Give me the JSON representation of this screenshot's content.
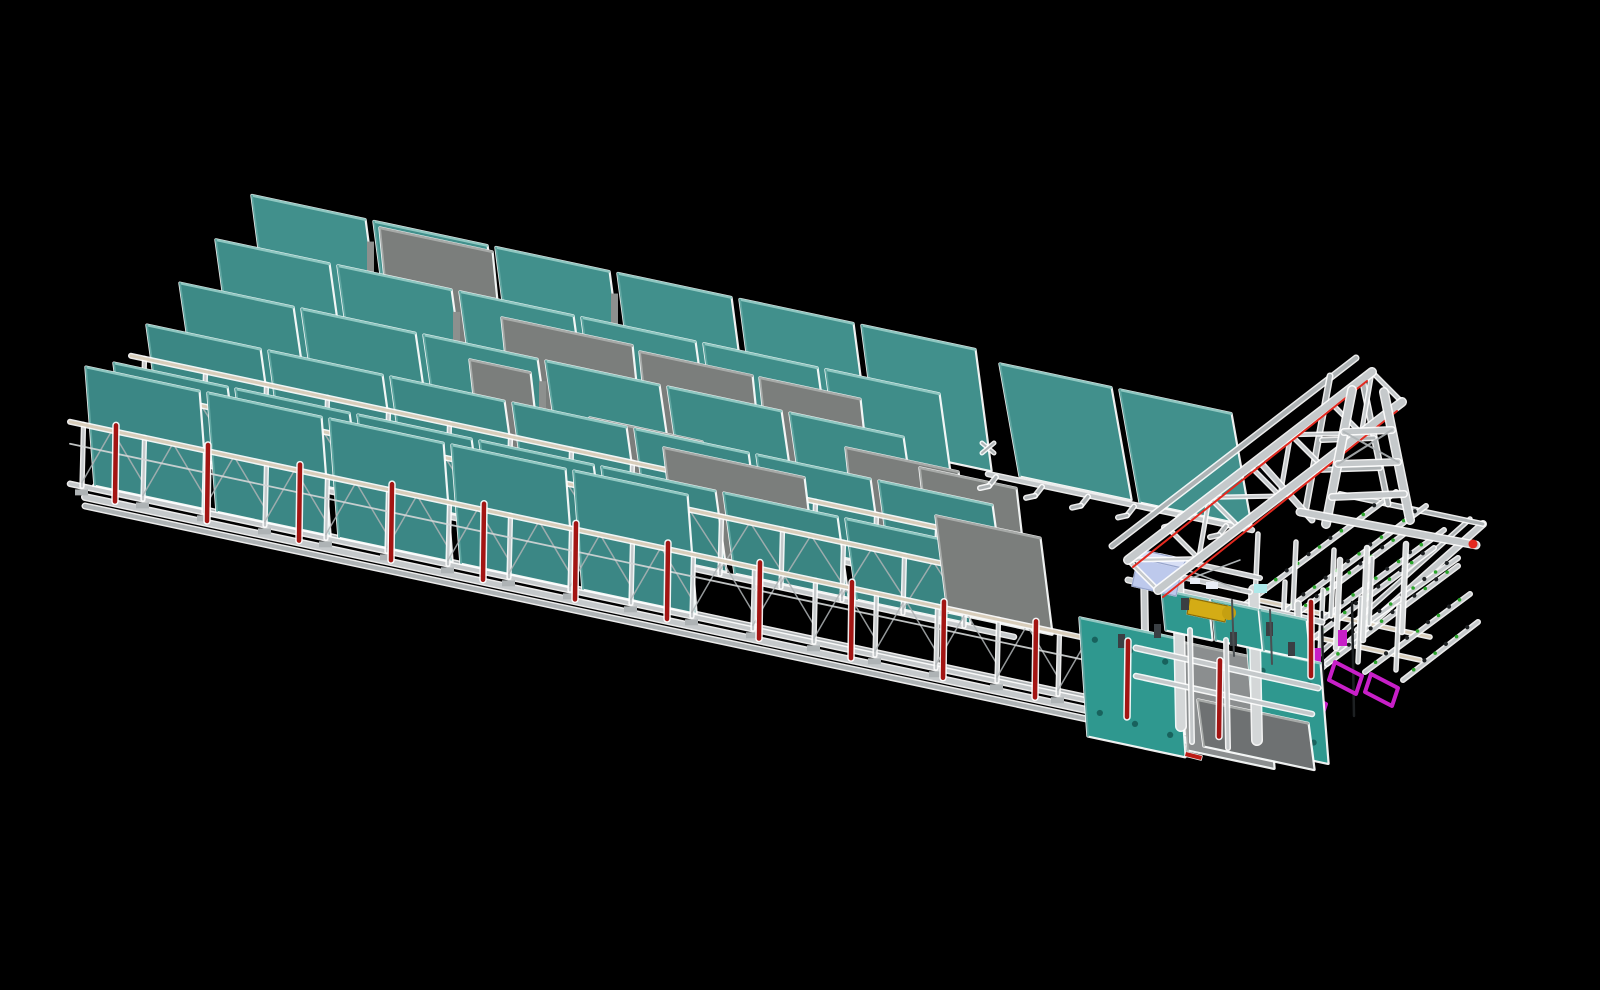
{
  "meta": {
    "background": "#000000",
    "width": 1600,
    "height": 990
  },
  "colors": {
    "bg": "#000000",
    "halo": "#FFFFFF",
    "tealEdge": "#8FC7C1",
    "tealSide": "#5FA6A1",
    "grayPanel": "#7B7E7C",
    "grayEdge": "#A7AAA8",
    "frame": "#C5C9CB",
    "frameLight": "#D4D7D8",
    "frameSoft": "#AEB3B5",
    "tan": "#D8CDBA",
    "red": "#A31513",
    "redBase": "#BB1B15",
    "redBright": "#E3291F",
    "yellow": "#D4AC15",
    "yellowDim": "#C5A011",
    "yellowDark": "#8A6D08",
    "blue": "#BDC9EC",
    "blueLight": "#D8DFF5",
    "blueEdge": "#96A4CB",
    "cyan": "#ADE9EA",
    "magenta": "#C81FC8",
    "green": "#2BA52B",
    "dark": "#3A3F43",
    "darkSoft": "#4A4F52",
    "clampDot": "#1D2022",
    "stationTeal": "#2F988F",
    "stationHole": "#18625D",
    "grayStation": "#8B8E8F",
    "grayDark": "#6E7172",
    "white2": "#E8EDF6",
    "gapSliver": "#8D908E"
  },
  "scene": {
    "rail": {
      "x0": 85,
      "y0": 497,
      "slope": 0.213
    },
    "base": {
      "front": [
        85,
        497,
        1237,
        742
      ],
      "front2dy": 9,
      "back_hint": [
        95,
        486,
        1247,
        731
      ],
      "right": [
        1237,
        742,
        1483,
        524
      ],
      "right_inner": [
        1228,
        735,
        1470,
        519
      ],
      "back_right": [
        1483,
        524,
        1340,
        494
      ]
    },
    "rows": [
      {
        "name": "panel-row-6-back",
        "x0": 252,
        "n": 6,
        "w": 113,
        "pitch": 122,
        "h": 121,
        "lean": 16,
        "off": 212,
        "fill": "#41908C",
        "gapSlivers": [
          0,
          2
        ],
        "graysBefore": []
      },
      {
        "name": "panel-row-5",
        "x0": 216,
        "n": 6,
        "w": 113,
        "pitch": 122,
        "h": 108,
        "lean": 15,
        "off": 173,
        "fill": "#3F8D89",
        "gapSlivers": [
          1,
          3
        ],
        "graysBefore": [
          {
            "tl": [
              380,
              228
            ],
            "w": 112,
            "h": 120
          }
        ]
      },
      {
        "name": "panel-row-4",
        "x0": 180,
        "n": 6,
        "w": 113,
        "pitch": 122,
        "h": 96,
        "lean": 14,
        "off": 134,
        "fill": "#3D8A86",
        "gapSlivers": [
          2
        ],
        "graysBefore": [
          {
            "tl": [
              502,
              318
            ],
            "w": 130,
            "h": 115
          },
          {
            "tl": [
              640,
              352
            ],
            "w": 112,
            "h": 115
          },
          {
            "tl": [
              760,
              378
            ],
            "w": 100,
            "h": 110
          }
        ]
      },
      {
        "name": "panel-row-3",
        "x0": 147,
        "n": 7,
        "w": 113,
        "pitch": 122,
        "h": 86,
        "lean": 12,
        "off": 95,
        "fill": "#3B8784",
        "rack": {
          "to": 1000,
          "postH": 54,
          "feet": false,
          "diag": false
        },
        "graysBefore": [
          {
            "tl": [
              470,
              360
            ],
            "w": 60,
            "h": 105
          },
          {
            "tl": [
              590,
              418
            ],
            "w": 112,
            "h": 105
          },
          {
            "tl": [
              846,
              448
            ],
            "w": 112,
            "h": 108
          },
          {
            "tl": [
              920,
              468
            ],
            "w": 96,
            "h": 104
          }
        ]
      },
      {
        "name": "panel-row-2",
        "x0": 114,
        "n": 7,
        "w": 113,
        "pitch": 122,
        "h": 80,
        "lean": 11,
        "off": 56,
        "fill": "#3A8582",
        "rack": {
          "to": 1014,
          "postH": 58,
          "feet": false,
          "diag": true
        },
        "graysBefore": [
          {
            "tl": [
              664,
              448
            ],
            "w": 140,
            "h": 100
          }
        ]
      },
      {
        "name": "panel-row-1-front",
        "x0": 86,
        "n": 5,
        "w": 113,
        "pitch": 122,
        "h": 118,
        "lean": 9,
        "off": 8,
        "fill": "#3B8785",
        "rack": {
          "to": 1164,
          "postH": 62,
          "feet": true,
          "diag": true
        },
        "graysBefore": [
          {
            "tl": [
              936,
              516
            ],
            "w": 104,
            "h": 96
          }
        ]
      }
    ],
    "right_rack": {
      "rail": [
        988,
        474,
        1252,
        530
      ],
      "feet_from": 996,
      "feet_to": 1250,
      "feet_every": 46,
      "panels": [
        {
          "tl": [
            1000,
            364
          ],
          "w": 111,
          "h": 112,
          "lean": 20
        },
        {
          "tl": [
            1120,
            390
          ],
          "w": 111,
          "h": 112,
          "lean": 20
        }
      ],
      "connector": [
        988,
        448
      ]
    },
    "grid": {
      "tanRails": [
        [
          1245,
          622,
          1420,
          660
        ],
        [
          1258,
          600,
          1430,
          637
        ]
      ],
      "beamsLow": [
        [
          1251,
          648,
          1404,
          534
        ],
        [
          1289,
          656,
          1434,
          548
        ],
        [
          1327,
          664,
          1458,
          566
        ],
        [
          1365,
          672,
          1470,
          594
        ],
        [
          1403,
          680,
          1478,
          622
        ]
      ],
      "beamsUp": [
        [
          1243,
          606,
          1396,
          492
        ],
        [
          1281,
          614,
          1426,
          506
        ],
        [
          1319,
          622,
          1444,
          530
        ],
        [
          1357,
          630,
          1458,
          558
        ]
      ],
      "pins": [
        [
          1255,
          600,
          1258,
          534
        ],
        [
          1293,
          608,
          1296,
          542
        ],
        [
          1331,
          616,
          1334,
          550
        ],
        [
          1369,
          624,
          1372,
          558
        ],
        [
          1282,
          646,
          1285,
          582
        ],
        [
          1320,
          654,
          1323,
          590
        ],
        [
          1358,
          662,
          1361,
          598
        ],
        [
          1396,
          670,
          1399,
          606
        ]
      ],
      "tallPins": [
        [
          1336,
          648,
          1340,
          560
        ],
        [
          1363,
          640,
          1367,
          548
        ],
        [
          1402,
          632,
          1406,
          544
        ]
      ],
      "darkBars": [
        [
          1322,
          612,
          1324,
          742
        ],
        [
          1352,
          602,
          1354,
          716
        ]
      ],
      "magentaRects": [
        [
          1338,
          630,
          9,
          16
        ],
        [
          1312,
          648,
          9,
          16
        ]
      ],
      "magentaUs": [
        [
          [
            1335,
            662
          ],
          [
            1362,
            676
          ],
          [
            1356,
            694
          ],
          [
            1329,
            680
          ]
        ],
        [
          [
            1371,
            674
          ],
          [
            1398,
            688
          ],
          [
            1392,
            706
          ],
          [
            1365,
            692
          ]
        ],
        [
          [
            1302,
            692
          ],
          [
            1326,
            704
          ],
          [
            1320,
            722
          ],
          [
            1296,
            710
          ]
        ]
      ]
    },
    "station": [
      {
        "t": "line",
        "p": [
          1128,
          580,
          1322,
          622
        ],
        "w": 4,
        "c": "frame",
        "g": 1
      },
      {
        "t": "line",
        "p": [
          1144,
          566,
          1146,
          700
        ],
        "w": 5,
        "c": "frame",
        "g": 1
      },
      {
        "t": "line",
        "p": [
          1298,
          604,
          1300,
          742
        ],
        "w": 5,
        "c": "frame",
        "g": 1
      },
      {
        "t": "quad",
        "tl": [
          1080,
          618
        ],
        "w": 97,
        "h": 118,
        "lean": 8,
        "f": "stationTeal",
        "holes": 6
      },
      {
        "t": "quad",
        "tl": [
          1180,
          642
        ],
        "w": 86,
        "h": 108,
        "lean": 8,
        "f": "grayStation"
      },
      {
        "t": "quad",
        "tl": [
          1248,
          648
        ],
        "w": 72,
        "h": 100,
        "lean": 8,
        "f": "stationTeal",
        "holes": 4
      },
      {
        "t": "quad",
        "tl": [
          1198,
          700
        ],
        "w": 110,
        "h": 46,
        "lean": 6,
        "f": "grayDark"
      },
      {
        "t": "line",
        "p": [
          1178,
          572,
          1181,
          726
        ],
        "w": 9,
        "c": "frameLight",
        "g": 1
      },
      {
        "t": "line",
        "p": [
          1254,
          590,
          1257,
          740
        ],
        "w": 9,
        "c": "frameLight",
        "g": 1
      },
      {
        "t": "line",
        "p": [
          1136,
          648,
          1318,
          688
        ],
        "w": 4,
        "c": "frame",
        "g": 1
      },
      {
        "t": "line",
        "p": [
          1136,
          676,
          1312,
          714
        ],
        "w": 3.5,
        "c": "frame",
        "g": 1
      },
      {
        "t": "quad",
        "tl": [
          1162,
          590
        ],
        "w": 46,
        "h": 40,
        "lean": 4,
        "f": "stationTeal"
      },
      {
        "t": "quad",
        "tl": [
          1212,
          600
        ],
        "w": 46,
        "h": 40,
        "lean": 4,
        "f": "stationTeal"
      },
      {
        "t": "quad",
        "tl": [
          1260,
          610
        ],
        "w": 46,
        "h": 40,
        "lean": 4,
        "f": "stationTeal"
      },
      {
        "t": "line",
        "p": [
          1150,
          570,
          1250,
          592
        ],
        "w": 3,
        "c": "frame",
        "g": 1
      },
      {
        "t": "line",
        "p": [
          1160,
          556,
          1260,
          578
        ],
        "w": 3,
        "c": "frame",
        "g": 1
      },
      {
        "t": "line",
        "p": [
          1160,
          560,
          1240,
          590
        ],
        "w": 1.5,
        "c": "frameSoft"
      },
      {
        "t": "line",
        "p": [
          1240,
          560,
          1160,
          590
        ],
        "w": 1.5,
        "c": "frameSoft"
      },
      {
        "t": "poly",
        "pts": [
          [
            1138,
            558
          ],
          [
            1182,
            568
          ],
          [
            1176,
            596
          ],
          [
            1132,
            586
          ]
        ],
        "f": "blue",
        "s": "blueEdge"
      },
      {
        "t": "poly",
        "pts": [
          [
            1138,
            558
          ],
          [
            1142,
            550
          ],
          [
            1186,
            560
          ],
          [
            1182,
            568
          ]
        ],
        "f": "blueLight",
        "s": "blueEdge"
      },
      {
        "t": "rect",
        "p": [
          1254,
          584,
          13,
          9
        ],
        "f": "cyan"
      },
      {
        "t": "rect",
        "p": [
          1190,
          578,
          10,
          6
        ],
        "f": "white2"
      },
      {
        "t": "rect",
        "p": [
          1206,
          582,
          12,
          7
        ],
        "f": "white2"
      },
      {
        "t": "poly",
        "pts": [
          [
            1190,
            598
          ],
          [
            1228,
            606
          ],
          [
            1225,
            622
          ],
          [
            1187,
            614
          ]
        ],
        "f": "yellow",
        "s": "yellowDark"
      },
      {
        "t": "circle",
        "p": [
          1229,
          613,
          7
        ],
        "f": "yellowDim"
      },
      {
        "t": "rect",
        "p": [
          1181,
          598,
          8,
          12
        ],
        "f": "dark"
      },
      {
        "t": "rect",
        "p": [
          1118,
          634,
          7,
          14
        ],
        "f": "dark"
      },
      {
        "t": "rect",
        "p": [
          1154,
          624,
          7,
          14
        ],
        "f": "dark"
      },
      {
        "t": "rect",
        "p": [
          1230,
          632,
          7,
          14
        ],
        "f": "dark"
      },
      {
        "t": "rect",
        "p": [
          1266,
          622,
          7,
          14
        ],
        "f": "dark"
      },
      {
        "t": "rect",
        "p": [
          1288,
          642,
          7,
          14
        ],
        "f": "dark"
      },
      {
        "t": "line",
        "p": [
          1232,
          600,
          1234,
          656
        ],
        "w": 2,
        "c": "darkSoft"
      },
      {
        "t": "line",
        "p": [
          1270,
          610,
          1272,
          664
        ],
        "w": 2,
        "c": "darkSoft"
      },
      {
        "t": "line",
        "p": [
          1190,
          630,
          1192,
          742
        ],
        "w": 3,
        "c": "frame",
        "g": 1
      },
      {
        "t": "line",
        "p": [
          1226,
          640,
          1228,
          748
        ],
        "w": 3,
        "c": "frame",
        "g": 1
      },
      {
        "t": "poly",
        "pts": [
          [
            1186,
            752
          ],
          [
            1202,
            756
          ],
          [
            1201,
            760
          ],
          [
            1185,
            756
          ]
        ],
        "f": "redBase"
      }
    ],
    "gantry": {
      "trussC": [
        1112,
        546,
        1356,
        358
      ],
      "trussA": [
        1128,
        560,
        1372,
        372
      ],
      "trussB": [
        1158,
        590,
        1402,
        402
      ],
      "bays": 6,
      "redA": [
        1133,
        567,
        1367,
        381
      ],
      "redB": [
        1163,
        597,
        1397,
        411
      ],
      "farLegs": [
        [
          1330,
          376,
          1306,
          508
        ],
        [
          1362,
          378,
          1388,
          504
        ]
      ],
      "farRungs": [
        [
          1322,
          440,
          1374,
          438
        ],
        [
          1316,
          470,
          1380,
          468
        ]
      ],
      "legs": [
        [
          1352,
          390,
          1326,
          524
        ],
        [
          1384,
          392,
          1410,
          520
        ]
      ],
      "rungs": [
        [
          1344,
          432,
          1392,
          430
        ],
        [
          1338,
          464,
          1398,
          462
        ],
        [
          1332,
          497,
          1404,
          494
        ]
      ],
      "xbrace": [
        [
          1344,
          432,
          1398,
          462
        ],
        [
          1392,
          430,
          1338,
          464
        ]
      ],
      "strut": [
        1260,
        462,
        1312,
        520
      ],
      "runway": [
        1300,
        512,
        1476,
        545
      ],
      "runwayCap": [
        1473,
        544
      ]
    },
    "red_posts": {
      "xs": [
        115,
        207,
        299,
        391,
        483,
        575,
        667,
        759,
        851,
        943,
        1035,
        1127,
        1219
      ],
      "h": 76,
      "w": 4.5,
      "extra": [
        [
          1311,
          602,
          1311,
          676
        ]
      ]
    }
  }
}
